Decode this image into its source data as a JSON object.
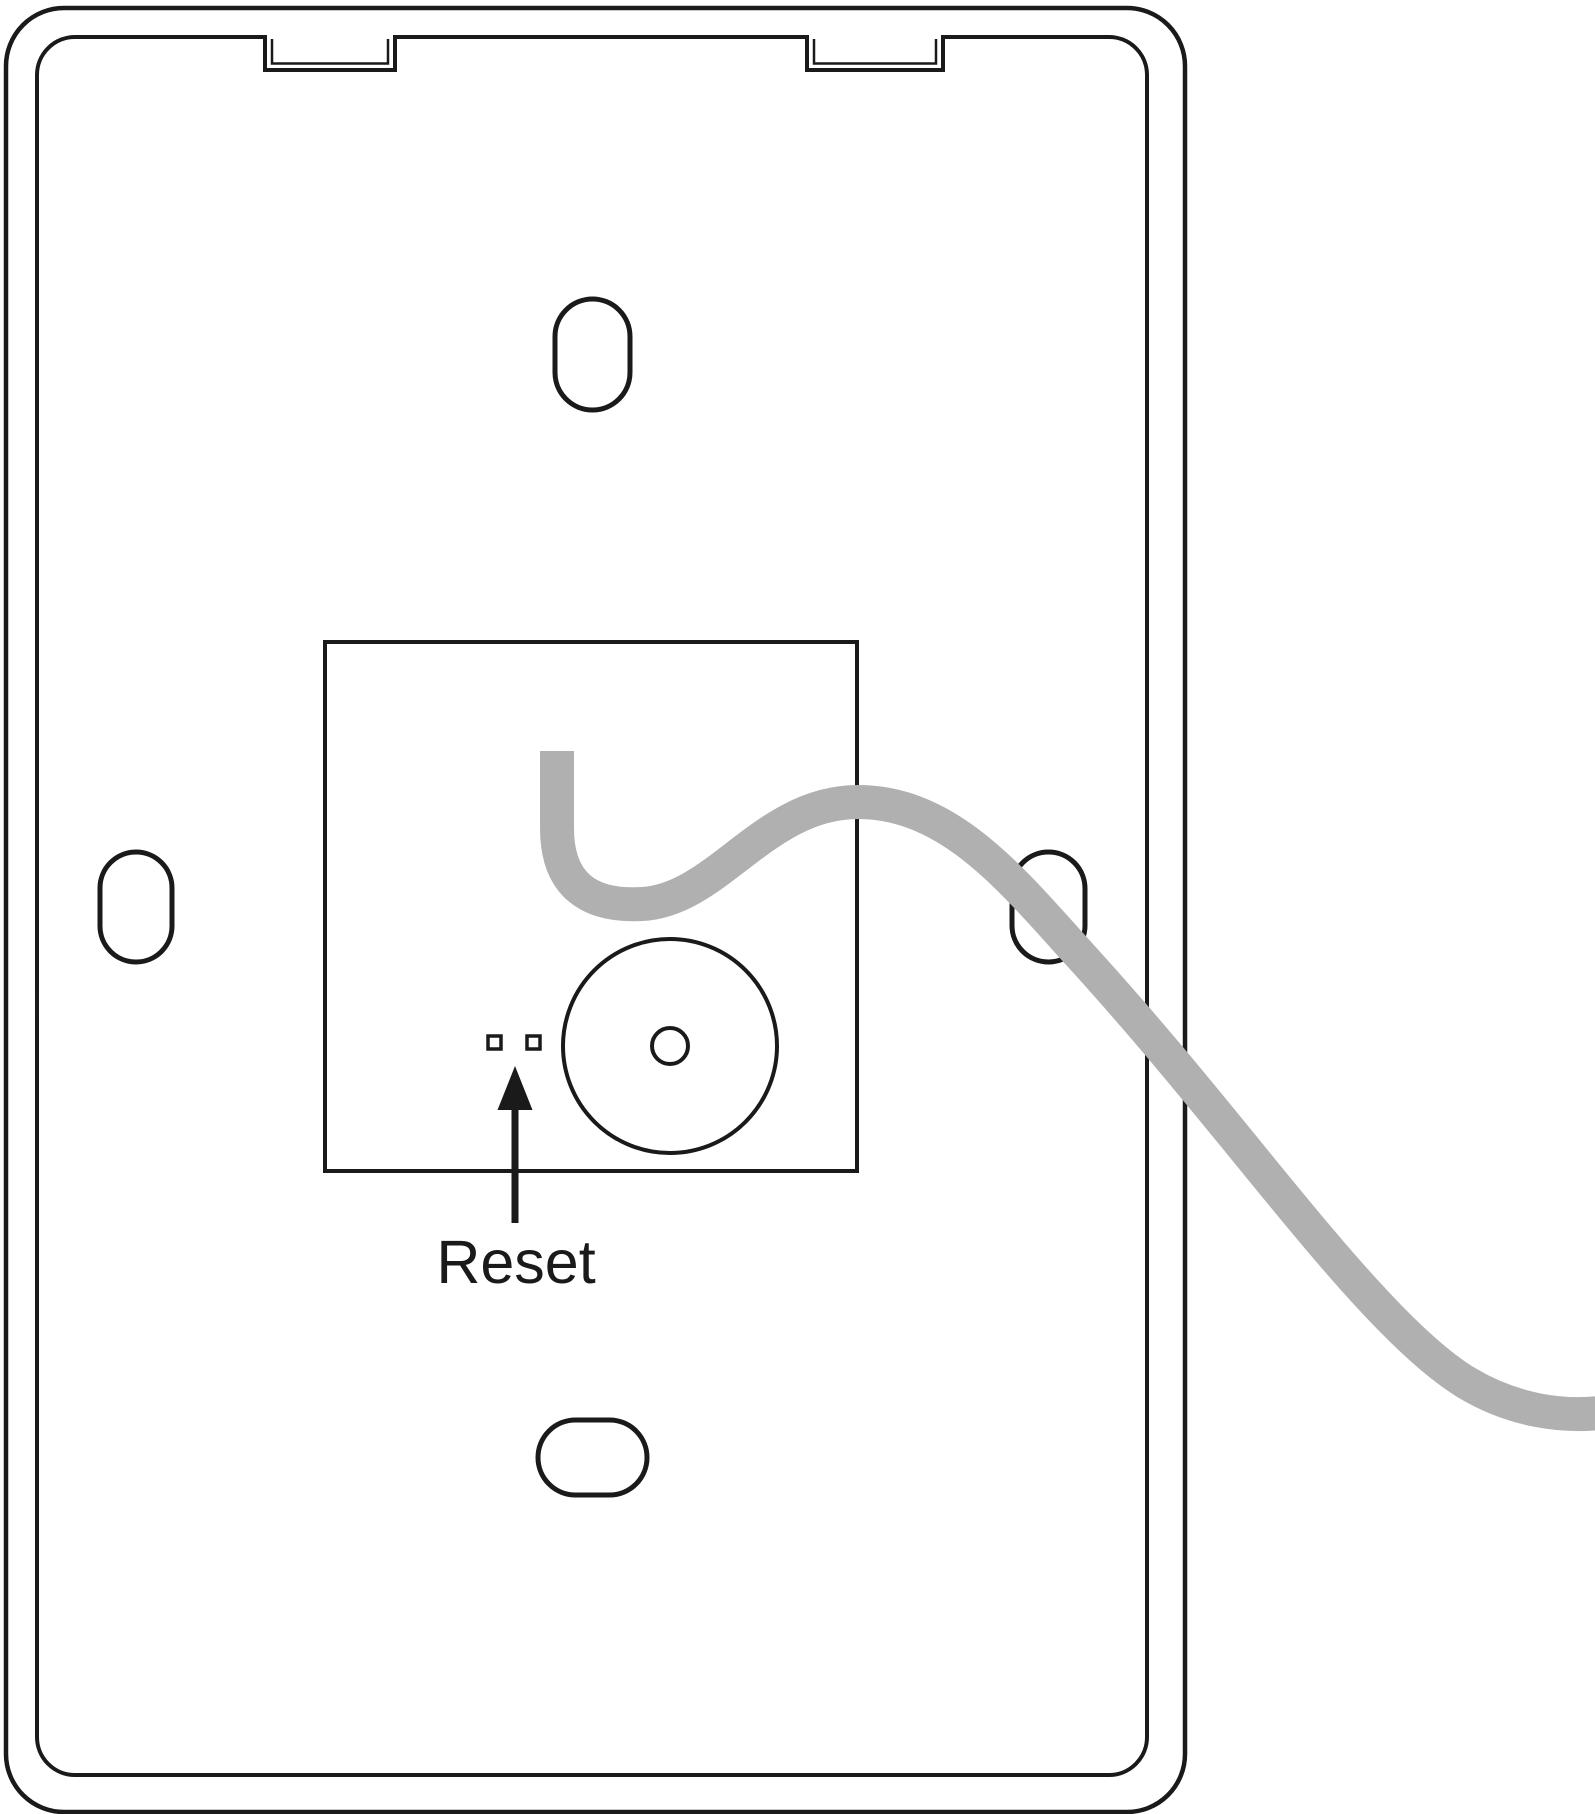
{
  "diagram": {
    "label_reset": "Reset",
    "colors": {
      "line": "#1a1a1a",
      "cable": "#b0b0b0",
      "background": "#ffffff"
    },
    "parts": [
      "device-outline",
      "inner-panel-outline",
      "mounting-notch-left",
      "mounting-notch-right",
      "mounting-hole-top",
      "mounting-hole-left",
      "mounting-hole-right",
      "mounting-hole-bottom",
      "component-cutout",
      "speaker-circle",
      "speaker-center-hole",
      "reset-contact-left",
      "reset-contact-right",
      "reset-pointer-arrow",
      "reset-label",
      "power-cable"
    ]
  }
}
